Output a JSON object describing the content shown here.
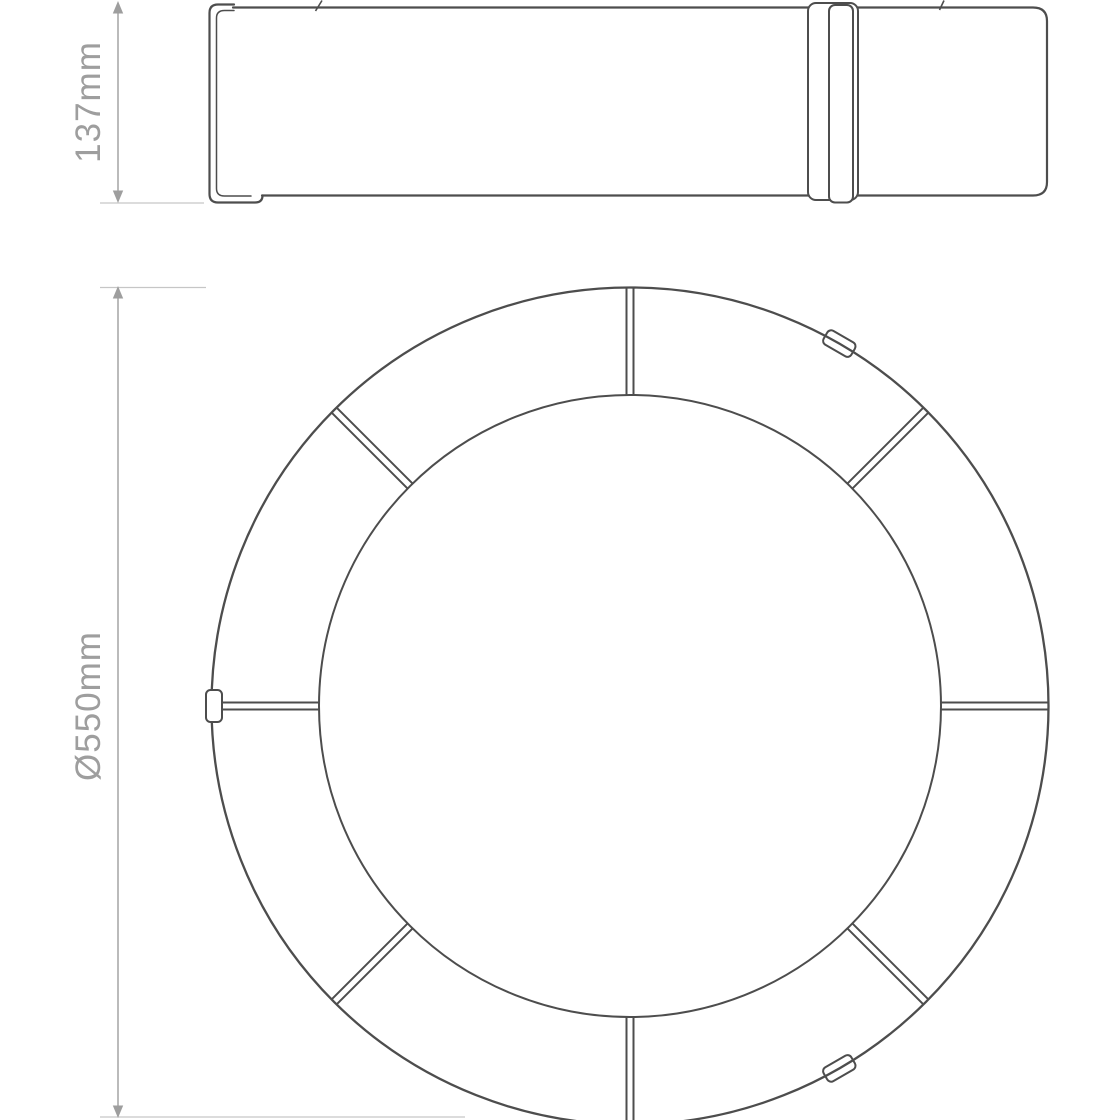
{
  "canvas": {
    "width": 1120,
    "height": 1120
  },
  "colors": {
    "line": "#4d4d4d",
    "dimension": "#9e9e9e",
    "extension": "#c6c6c6",
    "background": "#ffffff"
  },
  "side_view": {
    "description": "side elevation of circular ceiling light",
    "height_dimension": {
      "label": "137mm"
    }
  },
  "plan_view": {
    "description": "plan view of ring-shaped diffuser",
    "diameter_dimension": {
      "label": "Ø550mm"
    },
    "segment_count": 8,
    "clip_count": 3
  }
}
